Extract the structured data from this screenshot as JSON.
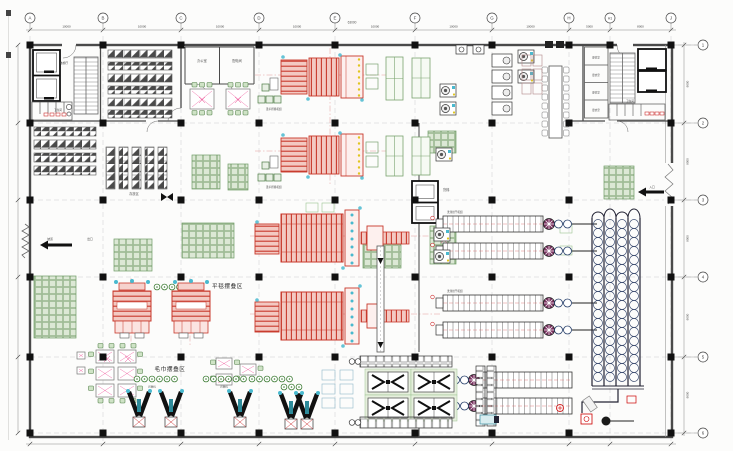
{
  "drawing": {
    "type": "factory-floor-plan",
    "grid": {
      "top_axes": [
        "A",
        "B",
        "C",
        "D",
        "E",
        "F",
        "G",
        "H",
        "H1",
        "J"
      ],
      "right_axes": [
        "1",
        "2",
        "3",
        "4",
        "5",
        "6"
      ],
      "top_dims": [
        "10000",
        "10000",
        "10000",
        "10000",
        "10000",
        "10000",
        "10000",
        "5000",
        "8000"
      ],
      "right_dims": [
        "9000",
        "9000",
        "9000",
        "9000",
        "9000"
      ],
      "overall_dim": "63000"
    },
    "zones": {
      "flat_fold": "平毯摆叠区",
      "towel_fold": "毛巾摆叠区",
      "storage": "存放区"
    },
    "rooms": {
      "office": "办公室",
      "power": "配电间",
      "locker": "更衣室",
      "toilet": "卫生间",
      "elevator_hall": "电梯厅",
      "freight_elevator": "货梯"
    },
    "machines": {
      "ironer_line": "烫平折叠机组",
      "tunnel_washer": "洗涤烘干机组",
      "folder": "折叠机"
    },
    "annotations": {
      "entry": "入口",
      "exit": "出口",
      "ramp": "坡道"
    },
    "colors": {
      "machine_red": "#c8382b",
      "machine_red_fill": "#f3c9c2",
      "pallet_green": "#6d9b64",
      "chair_green": "#cfe3c6",
      "ring_blue": "#3c4c70",
      "wall_gray": "#4a4a4a",
      "column_black": "#111111",
      "axis_pink": "#e08e8e",
      "accent_cyan": "#49b9cf",
      "accent_yellow": "#e0c51e",
      "wheel_purple": "#7c3462"
    }
  }
}
